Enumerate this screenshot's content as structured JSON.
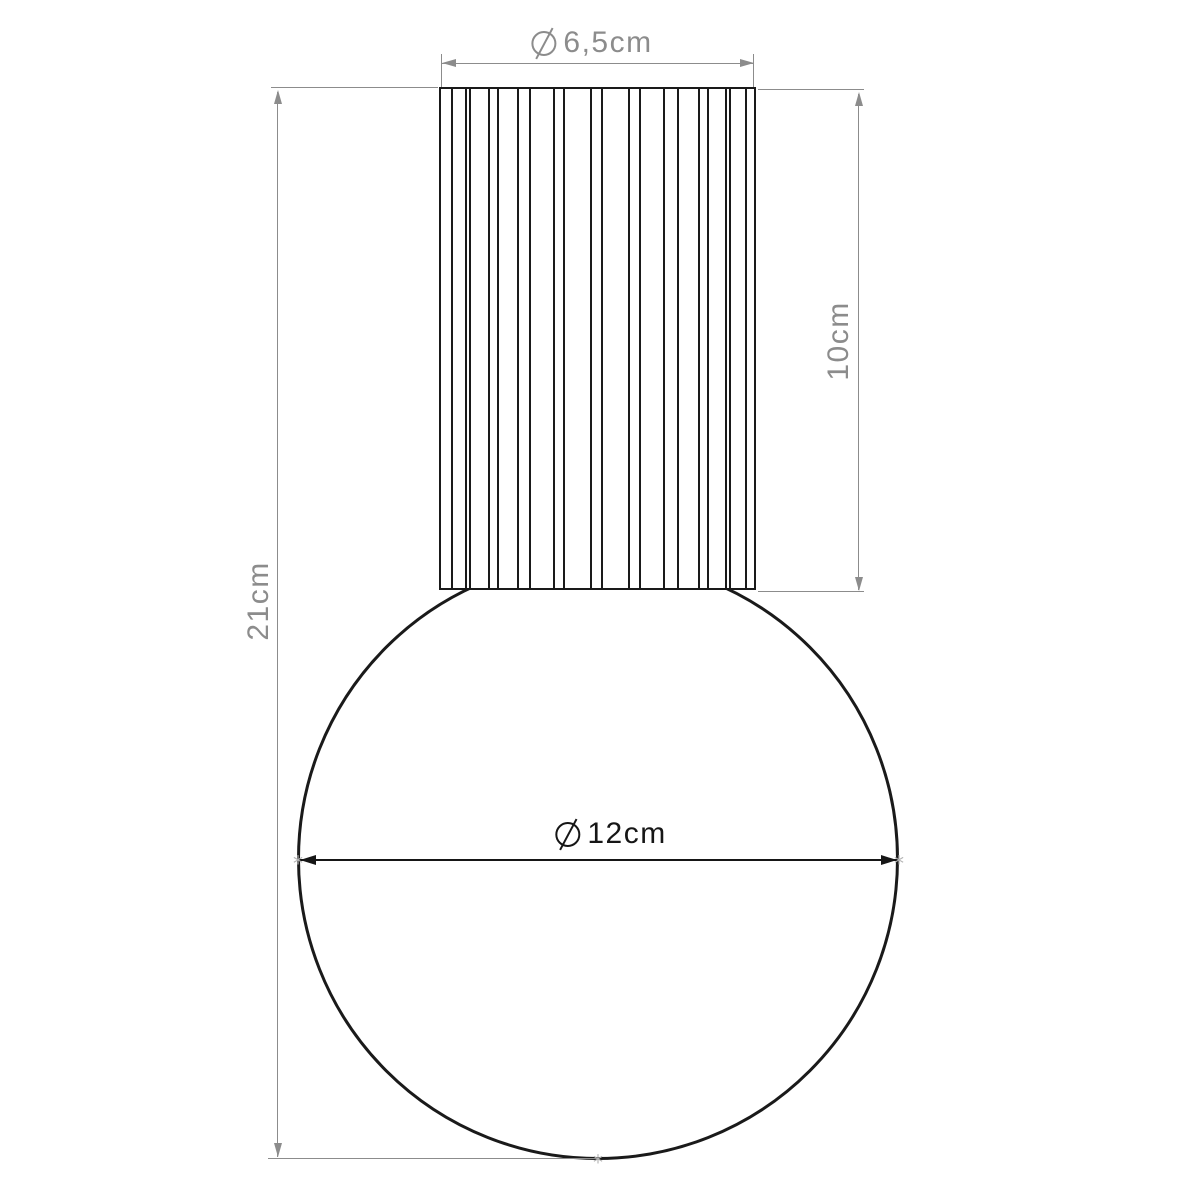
{
  "colors": {
    "background": "#ffffff",
    "outline": "#1a1a1a",
    "dim": "#8c8c8c",
    "dim-dark": "#161616",
    "marker": "#b3b3b3"
  },
  "dimensions": {
    "cylinder_diameter": {
      "symbol": "⌀",
      "text": "6,5cm"
    },
    "cylinder_height": {
      "text": "10cm"
    },
    "total_height": {
      "text": "21cm"
    },
    "globe_diameter": {
      "symbol": "⌀",
      "text": "12cm"
    }
  },
  "markers": {
    "endpoint_glyph": "*"
  }
}
